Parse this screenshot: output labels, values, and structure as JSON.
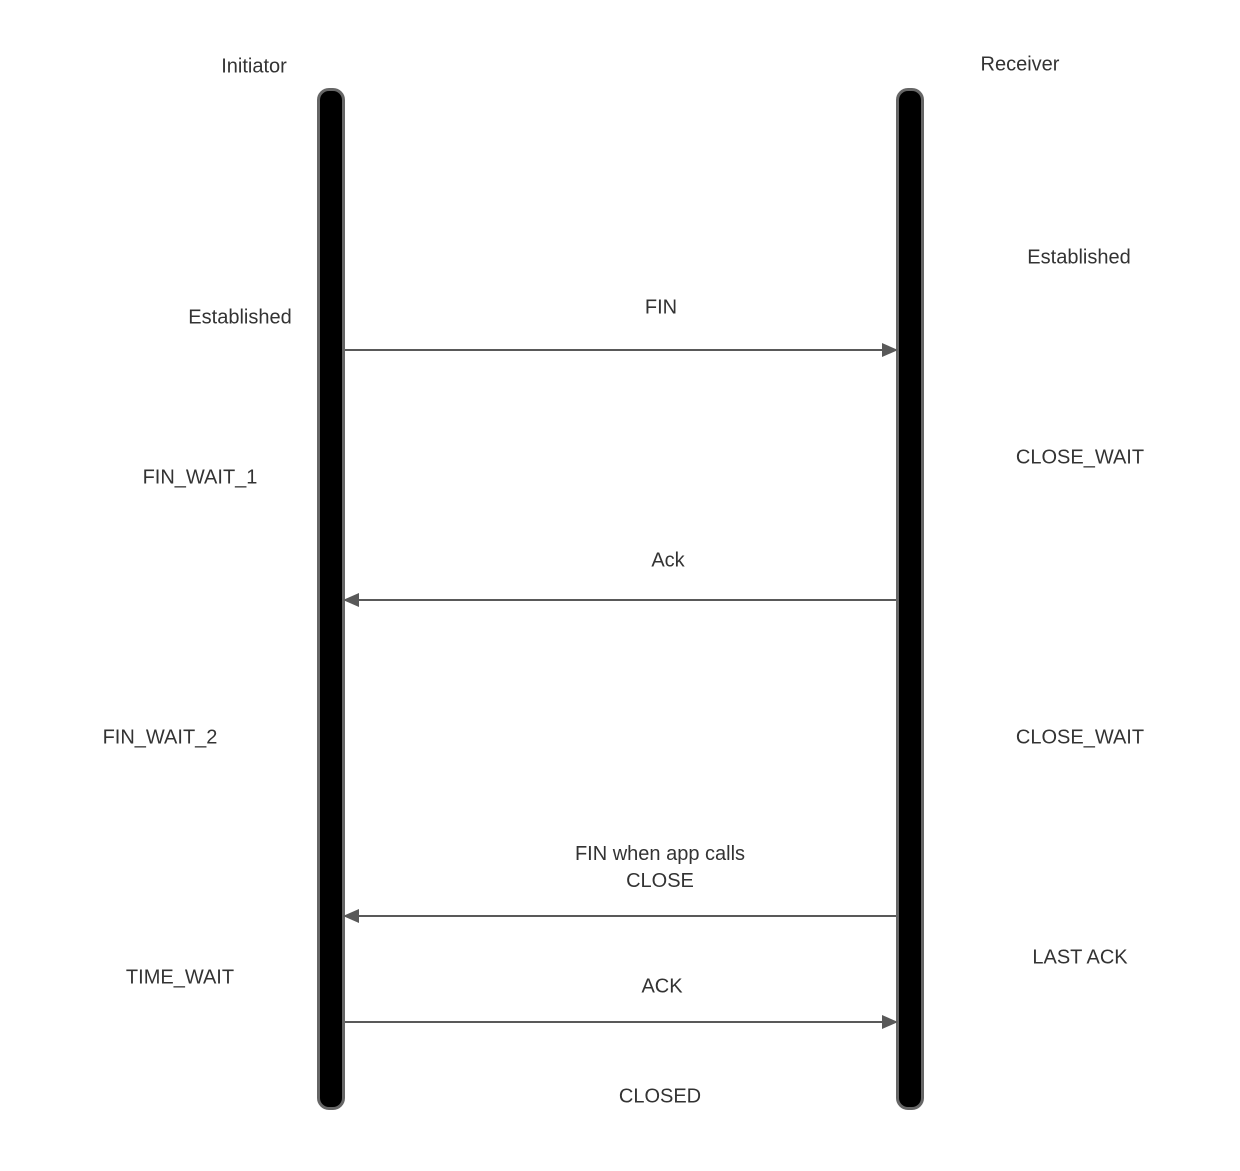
{
  "diagram": {
    "type": "sequence-diagram",
    "actors": [
      {
        "id": "initiator",
        "label": "Initiator"
      },
      {
        "id": "receiver",
        "label": "Receiver"
      }
    ],
    "messages": [
      {
        "label": "FIN",
        "from": "initiator",
        "to": "receiver"
      },
      {
        "label": "Ack",
        "from": "receiver",
        "to": "initiator"
      },
      {
        "label": "FIN when app calls\nCLOSE",
        "from": "receiver",
        "to": "initiator"
      },
      {
        "label": "ACK",
        "from": "initiator",
        "to": "receiver"
      }
    ],
    "initiator_states": [
      "Established",
      "FIN_WAIT_1",
      "FIN_WAIT_2",
      "TIME_WAIT"
    ],
    "receiver_states": [
      "Established",
      "CLOSE_WAIT",
      "CLOSE_WAIT",
      "LAST ACK"
    ],
    "final_state": "CLOSED",
    "colors": {
      "background": "#ffffff",
      "lifeline_fill": "#000000",
      "lifeline_border": "#666666",
      "arrow": "#595959",
      "text": "#333333"
    }
  }
}
